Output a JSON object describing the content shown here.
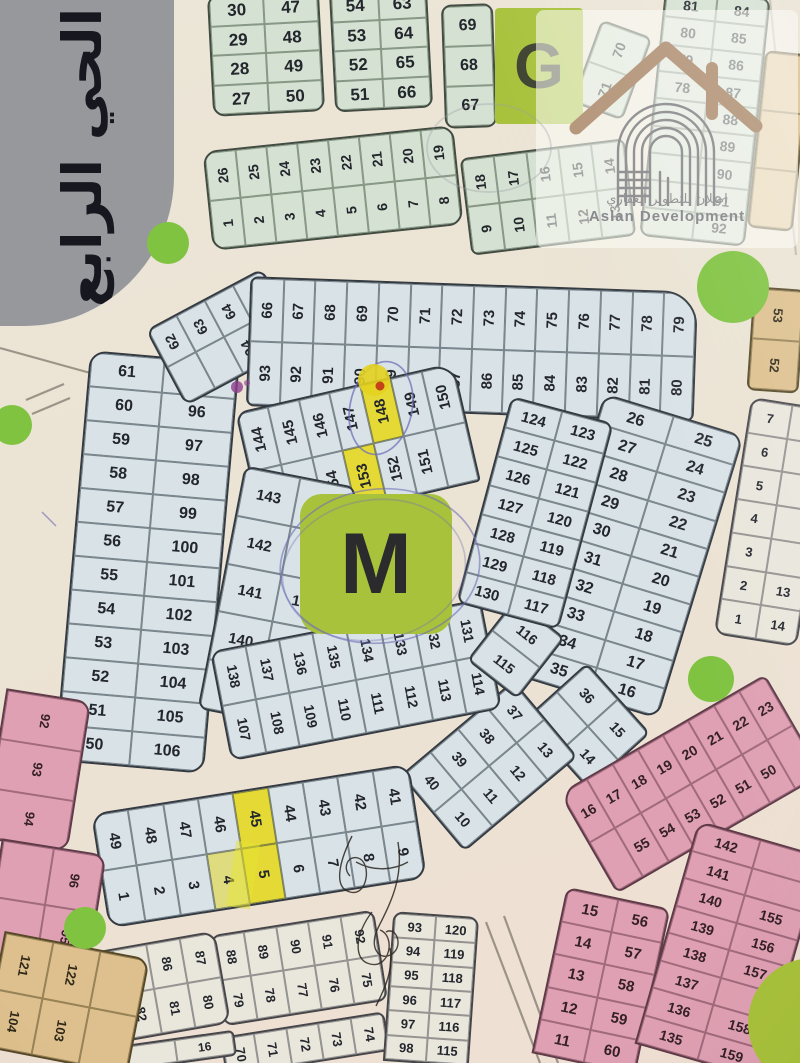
{
  "sign": {
    "text": "الحي الرابع"
  },
  "districts": {
    "g_letter": "G",
    "m_letter": "M"
  },
  "watermark": {
    "arabic": "اصلان للتطوير العقاري",
    "english": "Aslan Development"
  },
  "colors": {
    "lime_block": "#a8c23b",
    "roundabout_green": "#7fc340",
    "highlight_yellow": "#e5da35",
    "pen_blue": "#7070b8",
    "plot_green": "#d5e1d2",
    "plot_blue": "#d8e2e7",
    "plot_pink": "#dfa0b3",
    "plot_tan": "#ddc08d",
    "plot_white": "#e9e6dc"
  },
  "annotations": {
    "highlighted_plots": [
      "148",
      "153",
      "45",
      "5",
      "4"
    ]
  },
  "circles": [
    {
      "x": 168,
      "y": 243,
      "r": 21
    },
    {
      "x": 12,
      "y": 425,
      "r": 20
    },
    {
      "x": 733,
      "y": 287,
      "r": 36
    },
    {
      "x": 711,
      "y": 679,
      "r": 23
    },
    {
      "x": 85,
      "y": 928,
      "r": 21
    }
  ],
  "blocks": [
    {
      "n": "top-a",
      "c": "green",
      "x": 210,
      "y": -8,
      "w": 112,
      "h": 122,
      "rot": -3,
      "cols": 2,
      "fs": 17,
      "r": "12px",
      "cells": [
        "30",
        "47",
        "29",
        "48",
        "28",
        "49",
        "27",
        "50"
      ]
    },
    {
      "n": "top-b",
      "c": "green",
      "x": 332,
      "y": -12,
      "w": 98,
      "h": 122,
      "rot": -3,
      "cols": 2,
      "fs": 17,
      "r": "10px",
      "cells": [
        "54",
        "63",
        "53",
        "64",
        "52",
        "65",
        "51",
        "66"
      ]
    },
    {
      "n": "top-c",
      "c": "green",
      "x": 443,
      "y": 4,
      "w": 52,
      "h": 124,
      "rot": -2,
      "cols": 1,
      "fs": 16,
      "r": "10px",
      "cells": [
        "69",
        "68",
        "67"
      ]
    },
    {
      "n": "strip-1",
      "c": "green",
      "x": 207,
      "y": 138,
      "w": 252,
      "h": 100,
      "rot": -6,
      "cols": 8,
      "fs": 14,
      "tr": -90,
      "r": "14px",
      "cells": [
        "26",
        "25",
        "24",
        "23",
        "22",
        "21",
        "20",
        "19",
        "1",
        "2",
        "3",
        "4",
        "5",
        "6",
        "7",
        "8"
      ]
    },
    {
      "n": "strip-2",
      "c": "green",
      "x": 465,
      "y": 148,
      "w": 166,
      "h": 98,
      "rot": -7,
      "cols": 5,
      "fs": 14,
      "tr": -90,
      "r": "8px",
      "cells": [
        "18",
        "17",
        "16",
        "15",
        "14",
        "9",
        "10",
        "11",
        "12",
        "13"
      ]
    },
    {
      "n": "strip-3",
      "c": "green",
      "x": 585,
      "y": 26,
      "w": 54,
      "h": 88,
      "rot": 20,
      "cols": 1,
      "fs": 14,
      "tr": -90,
      "r": "8px",
      "cells": [
        "70",
        "71"
      ]
    },
    {
      "n": "col-ne",
      "c": "green",
      "x": 652,
      "y": -8,
      "w": 106,
      "h": 250,
      "rot": 6,
      "cols": 2,
      "fs": 14,
      "r": "10px",
      "cells": [
        "81",
        "84",
        "80",
        "85",
        "79",
        "86",
        "78",
        "87",
        "",
        "88",
        "",
        "89",
        "",
        "90",
        "",
        "91",
        "",
        "92"
      ]
    },
    {
      "n": "east-1",
      "c": "tan",
      "x": 756,
      "y": 52,
      "w": 46,
      "h": 178,
      "rot": 6,
      "cols": 1,
      "fs": 13,
      "r": "8px",
      "cells": [
        "",
        "",
        ""
      ]
    },
    {
      "n": "east-2",
      "c": "tan",
      "x": 750,
      "y": 288,
      "w": 52,
      "h": 104,
      "rot": 4,
      "cols": 1,
      "fs": 13,
      "tr": 90,
      "r": "8px",
      "cells": [
        "53",
        "52"
      ]
    },
    {
      "n": "east-3",
      "c": "white",
      "x": 732,
      "y": 402,
      "w": 84,
      "h": 240,
      "rot": 9,
      "cols": 2,
      "fs": 13,
      "r": "12px",
      "cells": [
        "7",
        "",
        "6",
        "",
        "5",
        "",
        "4",
        "",
        "3",
        "",
        "2",
        "13",
        "1",
        "14"
      ]
    },
    {
      "n": "ring-left",
      "c": "blue",
      "x": 72,
      "y": 356,
      "w": 150,
      "h": 412,
      "rot": 5,
      "cols": 2,
      "fs": 16,
      "r": "16px",
      "cells": [
        "61",
        "95",
        "60",
        "96",
        "59",
        "97",
        "58",
        "98",
        "57",
        "99",
        "56",
        "100",
        "55",
        "101",
        "54",
        "102",
        "53",
        "103",
        "52",
        "104",
        "51",
        "105",
        "50",
        "106"
      ]
    },
    {
      "n": "ring-topleft",
      "c": "blue",
      "x": 158,
      "y": 294,
      "w": 132,
      "h": 86,
      "rot": -28,
      "cols": 4,
      "fs": 14,
      "tr": -90,
      "r": "10px",
      "cells": [
        "62",
        "63",
        "64",
        "65",
        "",
        "",
        "94",
        ""
      ]
    },
    {
      "n": "ring-top",
      "c": "blue",
      "x": 248,
      "y": 284,
      "w": 448,
      "h": 130,
      "rot": 2,
      "cols": 14,
      "fs": 15,
      "tr": -90,
      "r": "8px 34px 8px 8px",
      "cells": [
        "66",
        "67",
        "68",
        "69",
        "70",
        "71",
        "72",
        "73",
        "74",
        "75",
        "76",
        "77",
        "78",
        "79",
        "93",
        "92",
        "91",
        "90",
        "89",
        "88",
        "87",
        "86",
        "85",
        "84",
        "83",
        "82",
        "81",
        "80"
      ]
    },
    {
      "n": "ring-right",
      "c": "blue",
      "x": 558,
      "y": 408,
      "w": 146,
      "h": 296,
      "rot": 17,
      "cols": 2,
      "fs": 16,
      "r": "14px",
      "cells": [
        "26",
        "25",
        "27",
        "24",
        "28",
        "23",
        "29",
        "22",
        "30",
        "21",
        "31",
        "20",
        "32",
        "19",
        "33",
        "18",
        "34",
        "17",
        "35",
        "16"
      ]
    },
    {
      "n": "ring-corner-se",
      "c": "blue",
      "x": 540,
      "y": 684,
      "w": 95,
      "h": 84,
      "rot": 48,
      "cols": 2,
      "fs": 14,
      "r": "8px",
      "cells": [
        "36",
        "15",
        "",
        "14"
      ]
    },
    {
      "n": "ring-corner-s",
      "c": "blue",
      "x": 415,
      "y": 716,
      "w": 148,
      "h": 100,
      "rot": -40,
      "cols": 4,
      "fs": 14,
      "tr": 90,
      "r": "8px",
      "cells": [
        "40",
        "39",
        "38",
        "37",
        "10",
        "11",
        "12",
        "13"
      ]
    },
    {
      "n": "ring-bottom",
      "c": "blue",
      "x": 98,
      "y": 788,
      "w": 322,
      "h": 116,
      "rot": -9,
      "cols": 9,
      "fs": 15,
      "tr": 90,
      "r": "16px",
      "cells": [
        "49",
        "48",
        "47",
        "46",
        {
          "t": "45",
          "hl": 1
        },
        "44",
        "43",
        "42",
        "41",
        "1",
        "2",
        "3",
        {
          "t": "4",
          "hl": 2
        },
        {
          "t": "5",
          "hl": 1
        },
        "6",
        "7",
        "8",
        "9"
      ]
    },
    {
      "n": "inner-top",
      "c": "blue",
      "x": 246,
      "y": 386,
      "w": 224,
      "h": 122,
      "rot": -13,
      "cols": 7,
      "fs": 15,
      "tr": -90,
      "r": "12px 22px 4px 4px",
      "cells": [
        "144",
        "145",
        "146",
        "147",
        {
          "t": "148",
          "hl": 1
        },
        "149",
        "150",
        "",
        "155",
        "154",
        {
          "t": "153",
          "hl": 1
        },
        "152",
        "151",
        ""
      ]
    },
    {
      "n": "inner-left",
      "c": "blue",
      "x": 220,
      "y": 474,
      "w": 114,
      "h": 248,
      "rot": 11,
      "cols": 2,
      "fs": 15,
      "r": "10px",
      "cells": [
        "143",
        "",
        "142",
        "156",
        "141",
        "157",
        "140",
        "158",
        "139",
        "159"
      ]
    },
    {
      "n": "inner-bottom",
      "c": "blue",
      "x": 218,
      "y": 624,
      "w": 276,
      "h": 112,
      "rot": -11,
      "cols": 8,
      "fs": 14,
      "tr": 90,
      "r": "12px",
      "cells": [
        "138",
        "137",
        "136",
        "135",
        "134",
        "133",
        "132",
        "131",
        "107",
        "108",
        "109",
        "110",
        "111",
        "112",
        "113",
        "114"
      ]
    },
    {
      "n": "inner-corner",
      "c": "blue",
      "x": 484,
      "y": 610,
      "w": 64,
      "h": 78,
      "rot": 38,
      "cols": 1,
      "fs": 14,
      "r": "8px",
      "cells": [
        "116",
        "115"
      ]
    },
    {
      "n": "inner-right",
      "c": "blue",
      "x": 482,
      "y": 406,
      "w": 106,
      "h": 214,
      "rot": 15,
      "cols": 2,
      "fs": 15,
      "r": "10px",
      "cells": [
        "124",
        "123",
        "125",
        "122",
        "126",
        "121",
        "127",
        "120",
        "128",
        "119",
        "129",
        "118",
        "130",
        "117"
      ]
    },
    {
      "n": "pink-top",
      "c": "pink",
      "x": 572,
      "y": 726,
      "w": 238,
      "h": 116,
      "rot": -30,
      "cols": 8,
      "fs": 14,
      "r": "18px 8px 8px 8px",
      "cells": [
        "16",
        "17",
        "18",
        "19",
        "20",
        "21",
        "22",
        "23",
        "",
        "55",
        "54",
        "53",
        "52",
        "51",
        "50",
        ""
      ]
    },
    {
      "n": "pink-left",
      "c": "pink",
      "x": 548,
      "y": 896,
      "w": 106,
      "h": 170,
      "rot": 12,
      "cols": 2,
      "fs": 15,
      "r": "10px 10px 0 0",
      "cells": [
        "15",
        "56",
        "14",
        "57",
        "13",
        "58",
        "12",
        "59",
        "11",
        "60"
      ]
    },
    {
      "n": "pink-inner",
      "c": "pink",
      "x": 664,
      "y": 834,
      "w": 130,
      "h": 232,
      "rot": 16,
      "cols": 2,
      "fs": 14,
      "r": "14px 14px 0 0",
      "cells": [
        "142",
        "",
        "141",
        "",
        "140",
        "155",
        "139",
        "156",
        "138",
        "157",
        "137",
        "",
        "136",
        "158",
        "135",
        "159"
      ]
    },
    {
      "n": "south-1",
      "c": "white",
      "x": 216,
      "y": 922,
      "w": 166,
      "h": 92,
      "rot": -9,
      "cols": 5,
      "fs": 13,
      "tr": 90,
      "r": "10px",
      "cells": [
        "88",
        "89",
        "90",
        "91",
        "92",
        "79",
        "78",
        "77",
        "76",
        "75"
      ]
    },
    {
      "n": "south-2",
      "c": "white",
      "x": 84,
      "y": 942,
      "w": 140,
      "h": 94,
      "rot": -10,
      "cols": 4,
      "fs": 13,
      "tr": 90,
      "r": "14px",
      "cells": [
        "84",
        "85",
        "86",
        "87",
        "83",
        "82",
        "81",
        "80"
      ]
    },
    {
      "n": "south-3",
      "c": "white",
      "x": 222,
      "y": 1024,
      "w": 166,
      "h": 40,
      "rot": -9,
      "cols": 5,
      "fs": 13,
      "tr": 90,
      "r": "8px 8px 0 0",
      "cells": [
        "70",
        "71",
        "72",
        "73",
        "74"
      ]
    },
    {
      "n": "south-4",
      "c": "white",
      "x": 388,
      "y": 914,
      "w": 86,
      "h": 150,
      "rot": 4,
      "cols": 2,
      "fs": 13,
      "r": "10px 10px 0 0",
      "cells": [
        "93",
        "120",
        "94",
        "119",
        "95",
        "118",
        "96",
        "117",
        "97",
        "116",
        "98",
        "115"
      ]
    },
    {
      "n": "south-5",
      "c": "white",
      "x": 116,
      "y": 1038,
      "w": 120,
      "h": 26,
      "rot": -8,
      "cols": 2,
      "fs": 12,
      "r": "6px",
      "cells": [
        "",
        "16"
      ]
    },
    {
      "n": "west-1",
      "c": "pink",
      "x": -6,
      "y": 694,
      "w": 86,
      "h": 152,
      "rot": 9,
      "cols": 1,
      "fs": 13,
      "tr": 90,
      "r": "0 14px 14px 0",
      "cells": [
        "92",
        "93",
        "94"
      ]
    },
    {
      "n": "west-2",
      "c": "pink",
      "x": -8,
      "y": 846,
      "w": 106,
      "h": 118,
      "rot": 9,
      "cols": 2,
      "fs": 13,
      "tr": 90,
      "r": "0 14px 14px 0",
      "cells": [
        "",
        "96",
        "",
        "95"
      ]
    },
    {
      "n": "west-3",
      "c": "tan",
      "x": -8,
      "y": 944,
      "w": 148,
      "h": 118,
      "rot": 11,
      "cols": 3,
      "fs": 13,
      "tr": 90,
      "r": "0 14px 0 0",
      "cells": [
        "121",
        "122",
        "",
        "104",
        "103",
        ""
      ]
    }
  ]
}
